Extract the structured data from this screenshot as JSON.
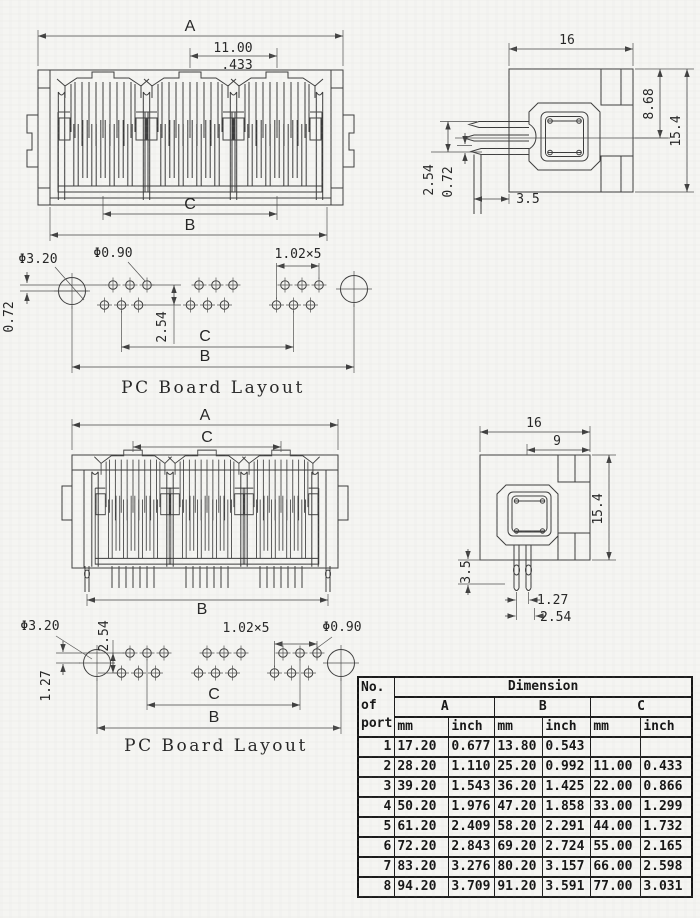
{
  "v1f": {
    "a": "A",
    "pitch_mm": "11.00",
    "pitch_in": ".433",
    "c": "C",
    "b": "B"
  },
  "v1s": {
    "w": "16",
    "d1": "8.68",
    "d2": "15.4",
    "p": "2.54",
    "o": "0.72",
    "t": "3.5"
  },
  "pcb1": {
    "big": "Φ3.20",
    "small": "Φ0.90",
    "pitch": "1.02×5",
    "off": "0.72",
    "row": "2.54",
    "c": "C",
    "b": "B",
    "caption": "PC Board Layout"
  },
  "v2f": {
    "a": "A",
    "c": "C",
    "b": "B"
  },
  "v2s": {
    "w": "16",
    "w2": "9",
    "h": "15.4",
    "t": "3.5",
    "p1": "1.27",
    "p2": "2.54"
  },
  "pcb2": {
    "big": "Φ3.20",
    "row": "2.54",
    "pitch": "1.02×5",
    "small": "Φ0.90",
    "off": "1.27",
    "c": "C",
    "b": "B",
    "caption": "PC Board Layout"
  },
  "table": {
    "no_lines": [
      "No.",
      "of",
      "port"
    ],
    "dimension": "Dimension",
    "cols": [
      "A",
      "B",
      "C"
    ],
    "unit_mm": "mm",
    "unit_inch": "inch",
    "rows": [
      [
        "1",
        "17.20",
        "0.677",
        "13.80",
        "0.543",
        "",
        ""
      ],
      [
        "2",
        "28.20",
        "1.110",
        "25.20",
        "0.992",
        "11.00",
        "0.433"
      ],
      [
        "3",
        "39.20",
        "1.543",
        "36.20",
        "1.425",
        "22.00",
        "0.866"
      ],
      [
        "4",
        "50.20",
        "1.976",
        "47.20",
        "1.858",
        "33.00",
        "1.299"
      ],
      [
        "5",
        "61.20",
        "2.409",
        "58.20",
        "2.291",
        "44.00",
        "1.732"
      ],
      [
        "6",
        "72.20",
        "2.843",
        "69.20",
        "2.724",
        "55.00",
        "2.165"
      ],
      [
        "7",
        "83.20",
        "3.276",
        "80.20",
        "3.157",
        "66.00",
        "2.598"
      ],
      [
        "8",
        "94.20",
        "3.709",
        "91.20",
        "3.591",
        "77.00",
        "3.031"
      ]
    ]
  }
}
